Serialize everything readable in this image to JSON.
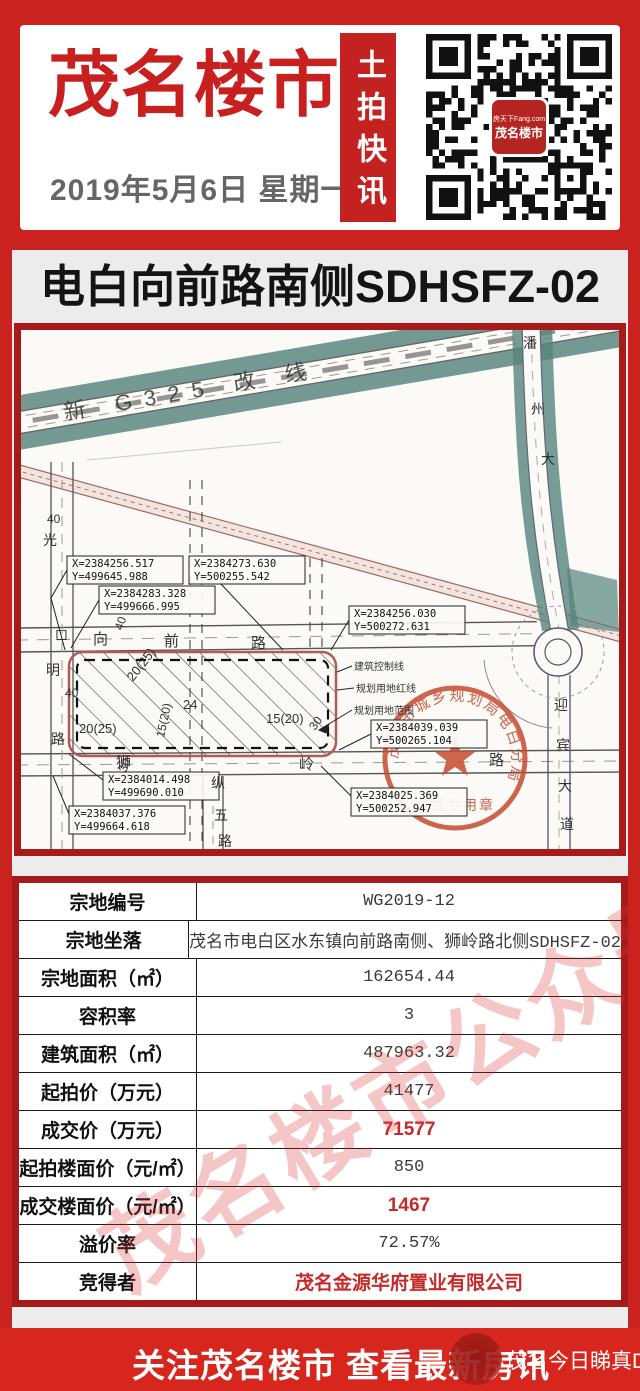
{
  "colors": {
    "page_red": "#C9221F",
    "dark_red_border": "#A81A1A",
    "brand_red": "#C8201E",
    "footer_red": "#D7261E",
    "teal_road": "#55847C",
    "stamp_red": "#C84A2F",
    "table_value_red": "#C52A2A"
  },
  "header": {
    "brand": "茂名楼市",
    "date": "2019年5月6日 星期一",
    "ribbon": "土拍快讯",
    "qr_line1": "房天下Fang.com",
    "qr_line2": "茂名楼市"
  },
  "banner": {
    "text": "电白向前路南侧SDHSFZ-02"
  },
  "map": {
    "stamp": {
      "arc": "茂名市城乡规划局电白分局",
      "bottom": "审批专用章"
    },
    "labels": [
      {
        "t": "新 G325 改 线",
        "x": 44,
        "y": 90,
        "s": 22,
        "rot": -9.7,
        "ls": 12,
        "c": "#2b2b2b",
        "o": 0.8
      },
      {
        "t": "潘",
        "x": 502,
        "y": 18,
        "s": 14
      },
      {
        "t": "州",
        "x": 510,
        "y": 84,
        "s": 14
      },
      {
        "t": "大",
        "x": 520,
        "y": 134,
        "s": 14
      },
      {
        "t": "迎",
        "x": 533,
        "y": 380,
        "s": 14
      },
      {
        "t": "宾",
        "x": 535,
        "y": 420,
        "s": 14
      },
      {
        "t": "大",
        "x": 537,
        "y": 461,
        "s": 14
      },
      {
        "t": "道",
        "x": 539,
        "y": 499,
        "s": 14
      },
      {
        "t": "向",
        "x": 72,
        "y": 314,
        "s": 15
      },
      {
        "t": "前",
        "x": 143,
        "y": 316,
        "s": 15
      },
      {
        "t": "路",
        "x": 230,
        "y": 318,
        "s": 15
      },
      {
        "t": "40",
        "x": 101,
        "y": 301,
        "s": 12,
        "rot": -70
      },
      {
        "t": "狮",
        "x": 95,
        "y": 437,
        "s": 15
      },
      {
        "t": "岭",
        "x": 278,
        "y": 439,
        "s": 15
      },
      {
        "t": "路",
        "x": 468,
        "y": 435,
        "s": 15
      },
      {
        "t": "纵",
        "x": 190,
        "y": 458,
        "s": 14
      },
      {
        "t": "五",
        "x": 193,
        "y": 490,
        "s": 14
      },
      {
        "t": "路",
        "x": 197,
        "y": 516,
        "s": 14
      },
      {
        "t": "光",
        "x": 22,
        "y": 215,
        "s": 14
      },
      {
        "t": "明",
        "x": 25,
        "y": 345,
        "s": 14
      },
      {
        "t": "路",
        "x": 30,
        "y": 414,
        "s": 14
      },
      {
        "t": "40",
        "x": 26,
        "y": 193,
        "s": 12
      },
      {
        "t": "40",
        "x": 44,
        "y": 367,
        "s": 12
      },
      {
        "t": "20(25)",
        "x": 112,
        "y": 352,
        "s": 13,
        "rot": -52
      },
      {
        "t": "24",
        "x": 162,
        "y": 379,
        "s": 13
      },
      {
        "t": "15(20)",
        "x": 143,
        "y": 408,
        "s": 12,
        "rot": -78
      },
      {
        "t": "20(25)",
        "x": 58,
        "y": 403,
        "s": 13
      },
      {
        "t": "15(20)",
        "x": 245,
        "y": 393,
        "s": 13
      },
      {
        "t": "30",
        "x": 294,
        "y": 401,
        "s": 12,
        "rot": -55
      },
      {
        "t": "30",
        "x": 105,
        "y": 443,
        "s": 12,
        "rot": -70
      },
      {
        "t": "建筑控制线",
        "x": 333,
        "y": 340,
        "s": 10
      },
      {
        "t": "规划用地红线",
        "x": 335,
        "y": 362,
        "s": 10
      },
      {
        "t": "规划用地范围",
        "x": 333,
        "y": 384,
        "s": 10
      }
    ],
    "callouts": [
      {
        "x": 46,
        "y": 226,
        "a": "X=2384256.517",
        "b": "Y=499645.988",
        "pts": "46,240 30,268 44,320"
      },
      {
        "x": 168,
        "y": 226,
        "a": "X=2384273.630",
        "b": "Y=500255.542",
        "pts": "200,254 262,320"
      },
      {
        "x": 78,
        "y": 256,
        "a": "X=2384283.328",
        "b": "Y=499666.995",
        "pts": "78,270 50,318"
      },
      {
        "x": 328,
        "y": 276,
        "a": "X=2384256.030",
        "b": "Y=500272.631",
        "pts": "328,290 310,320"
      },
      {
        "x": 350,
        "y": 390,
        "a": "X=2384039.039",
        "b": "Y=500265.104",
        "pts": "350,404 318,420"
      },
      {
        "x": 330,
        "y": 458,
        "a": "X=2384025.369",
        "b": "Y=500252.947",
        "pts": "330,466 300,436"
      },
      {
        "x": 82,
        "y": 442,
        "a": "X=2384014.498",
        "b": "Y=499690.010",
        "pts": "82,450 48,424"
      },
      {
        "x": 48,
        "y": 476,
        "a": "X=2384037.376",
        "b": "Y=499664.618",
        "pts": "48,484 32,446"
      }
    ]
  },
  "table": {
    "rows": [
      {
        "label": "宗地编号",
        "value": "WG2019-12",
        "red": false
      },
      {
        "label": "宗地坐落",
        "value": "茂名市电白区水东镇向前路南侧、狮岭路北侧SDHSFZ-02",
        "red": false
      },
      {
        "label": "宗地面积（㎡）",
        "value": "162654.44",
        "red": false
      },
      {
        "label": "容积率",
        "value": "3",
        "red": false
      },
      {
        "label": "建筑面积（㎡）",
        "value": "487963.32",
        "red": false
      },
      {
        "label": "起拍价（万元）",
        "value": "41477",
        "red": false
      },
      {
        "label": "成交价（万元）",
        "value": "71577",
        "red": true
      },
      {
        "label": "起拍楼面价（元/㎡）",
        "value": "850",
        "red": false
      },
      {
        "label": "成交楼面价（元/㎡）",
        "value": "1467",
        "red": true
      },
      {
        "label": "溢价率",
        "value": "72.57%",
        "red": false
      },
      {
        "label": "竞得者",
        "value": "茂名金源华府置业有限公司",
        "red": true
      }
    ]
  },
  "watermark": {
    "table_text": "茂名楼市公众号"
  },
  "footer": {
    "cta": "关注茂名楼市 查看最新房讯",
    "watermark": "茂名今日睇真D"
  }
}
